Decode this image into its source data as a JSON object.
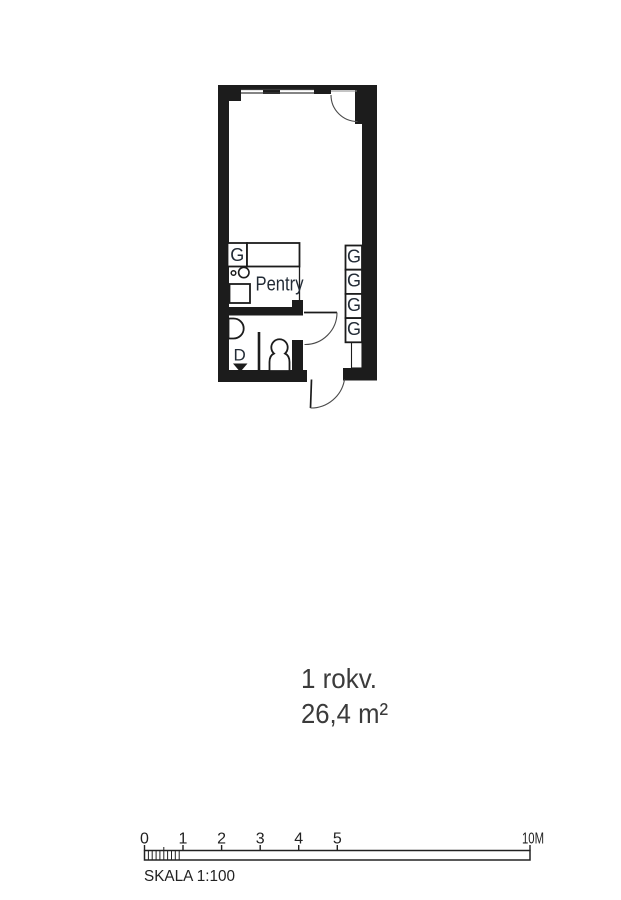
{
  "document": {
    "background_color": "#ffffff",
    "ink_color": "#1c1c1c",
    "label_color": "#222b36",
    "title_color": "#3b3b3b"
  },
  "plan": {
    "unit_title": "1 rokv.",
    "unit_area": "26,4 m²",
    "kitchen": {
      "label": "Pentry",
      "wardrobe_label": "G"
    },
    "bathroom": {
      "drain_label": "D"
    },
    "hall_wardrobe_labels": [
      "G",
      "G",
      "G",
      "G"
    ]
  },
  "scale_bar": {
    "tick_labels": [
      "0",
      "1",
      "2",
      "3",
      "4",
      "5"
    ],
    "end_label": "10M",
    "caption": "SKALA 1:100"
  }
}
